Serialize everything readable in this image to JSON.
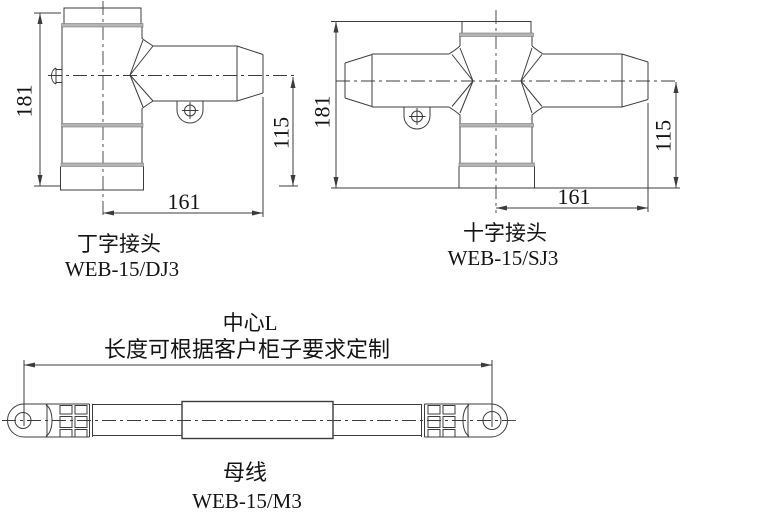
{
  "drawing": {
    "t_joint": {
      "title": "丁字接头",
      "model": "WEB-15/DJ3",
      "height": "181",
      "branch_height": "115",
      "width": "161"
    },
    "cross_joint": {
      "title": "十字接头",
      "model": "WEB-15/SJ3",
      "height": "181",
      "branch_height": "115",
      "width": "161"
    },
    "busbar": {
      "title": "母线",
      "model": "WEB-15/M3",
      "center_label": "中心L",
      "length_note": "长度可根据客户柜子要求定制"
    }
  },
  "colors": {
    "line": "#3c3c3c",
    "band": "#b4b4b4",
    "background": "#ffffff"
  }
}
